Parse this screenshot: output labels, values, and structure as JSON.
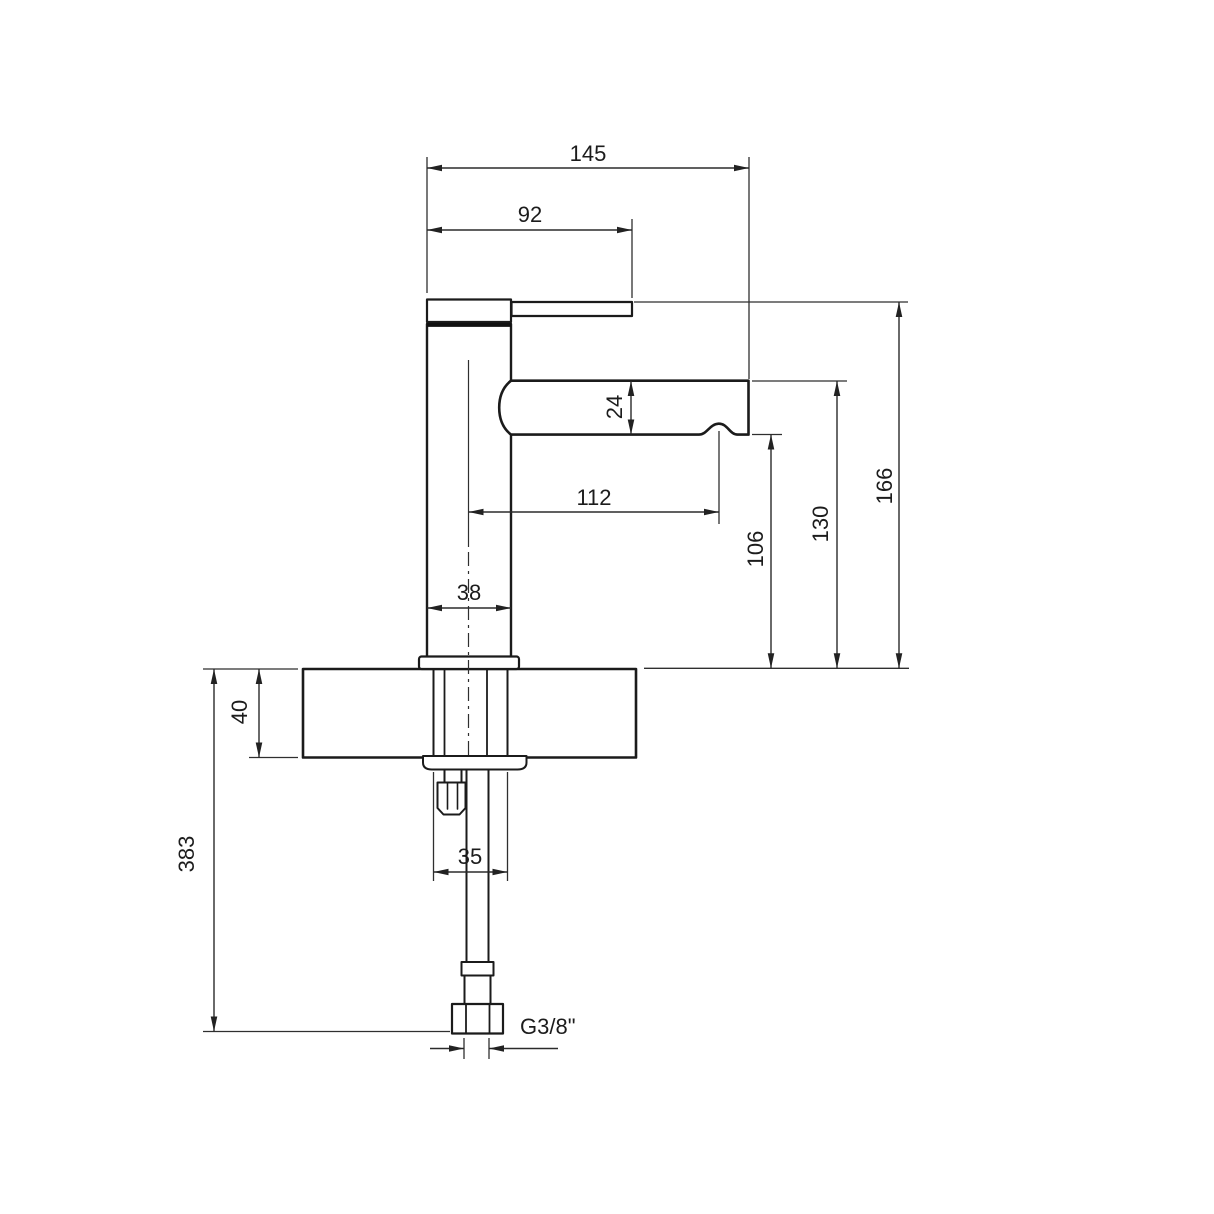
{
  "page": {
    "background": "#ffffff",
    "description": "Technical installation drawing of a single-lever basin mixer tap, side elevation with millimetre dimensions"
  },
  "drawing": {
    "units": "mm",
    "line_color": "#1b1b1b",
    "labels": {
      "overall_projection": "145",
      "handle_projection": "92",
      "spout_thickness": "24",
      "spout_reach": "112",
      "outlet_height": "106",
      "spout_top_height": "130",
      "overall_height": "166",
      "body_diameter": "38",
      "deck_thickness": "40",
      "overall_depth_with_hose": "383",
      "shank_width": "35",
      "inlet_thread": "G3/8\""
    }
  }
}
